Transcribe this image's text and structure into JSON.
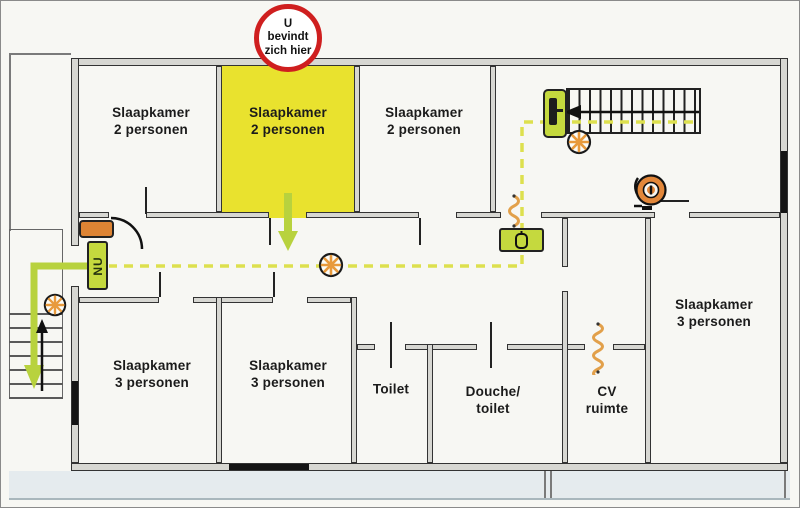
{
  "badge": {
    "line1": "U",
    "line2": "bevindt",
    "line3": "zich hier"
  },
  "rooms": [
    {
      "id": "bedroom-top-left",
      "line1": "Slaapkamer",
      "line2": "2 personen",
      "highlighted": false
    },
    {
      "id": "bedroom-top-center",
      "line1": "Slaapkamer",
      "line2": "2 personen",
      "highlighted": true
    },
    {
      "id": "bedroom-top-right",
      "line1": "Slaapkamer",
      "line2": "2 personen",
      "highlighted": false
    },
    {
      "id": "bedroom-bottom-left",
      "line1": "Slaapkamer",
      "line2": "3 personen",
      "highlighted": false
    },
    {
      "id": "bedroom-bottom-center",
      "line1": "Slaapkamer",
      "line2": "3 personen",
      "highlighted": false
    },
    {
      "id": "toilet",
      "line1": "Toilet",
      "line2": ""
    },
    {
      "id": "shower-toilet",
      "line1": "Douche/",
      "line2": "toilet"
    },
    {
      "id": "cv-room",
      "line1": "CV",
      "line2": "ruimte"
    },
    {
      "id": "bedroom-right",
      "line1": "Slaapkamer",
      "line2": "3 personen",
      "highlighted": false
    }
  ],
  "signs": {
    "emergency_exit_label": "NU"
  },
  "icons": {
    "you_are_here_badge": "red-circle-badge",
    "emergency_light": "starburst-circle",
    "fire_hose_reel": "orange-reel",
    "exit_door": "green-door",
    "equipment_cabinet": "green-box",
    "fire_extinguisher": "orange-box",
    "self_closing_door": "orange-squiggle",
    "escape_route": "dashed-yellow-line",
    "escape_direction": "green-arrow",
    "stairs_up": "black-arrow"
  },
  "colors": {
    "highlight_yellow": "#e9e22e",
    "badge_red": "#cf1f1f",
    "route_dash_yellow": "#dde04e",
    "arrow_green": "#b8d23e",
    "sign_green": "#c5d93e",
    "icon_orange": "#e2873a",
    "wall_fill": "#d7d7d2",
    "ground_gray": "#e5ebee"
  }
}
